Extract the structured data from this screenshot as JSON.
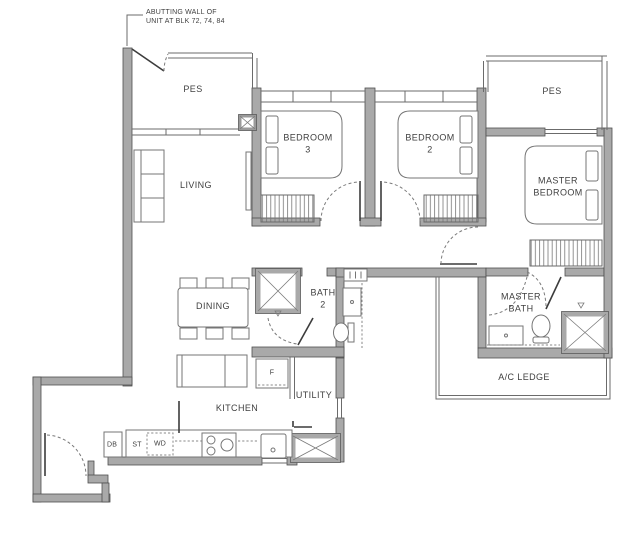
{
  "annotation": {
    "abutting_wall": "ABUTTING WALL OF\nUNIT AT BLK 72, 74, 84"
  },
  "rooms": {
    "pes_left": "PES",
    "pes_right": "PES",
    "living": "LIVING",
    "bedroom3": "BEDROOM\n3",
    "bedroom2": "BEDROOM\n2",
    "master_bedroom": "MASTER\nBEDROOM",
    "dining": "DINING",
    "bath2": "BATH\n2",
    "master_bath": "MASTER\nBATH",
    "ac_ledge": "A/C LEDGE",
    "kitchen": "KITCHEN",
    "utility": "UTILITY"
  },
  "fixtures": {
    "fridge": "F",
    "db": "DB",
    "st": "ST",
    "wd": "WD"
  },
  "colors": {
    "wall_fill": "#a9a9a9",
    "wall_edge": "#4f4f4f",
    "line": "#6b6b6b",
    "text": "#3f3f3f",
    "background": "#ffffff"
  }
}
